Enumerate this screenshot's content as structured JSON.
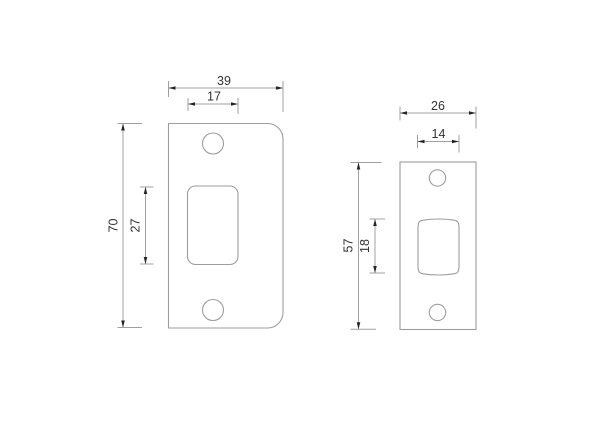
{
  "colors": {
    "background": "#ffffff",
    "outline": "#9d9d9d",
    "dimension_line": "#a0a0a0",
    "arrow": "#262626",
    "text": "#333333"
  },
  "plates": {
    "large": {
      "dims": {
        "width": "39",
        "slot_width": "17",
        "height": "70",
        "slot_height": "27"
      }
    },
    "small": {
      "dims": {
        "width": "26",
        "slot_width": "14",
        "height": "57",
        "slot_height": "18"
      }
    }
  }
}
